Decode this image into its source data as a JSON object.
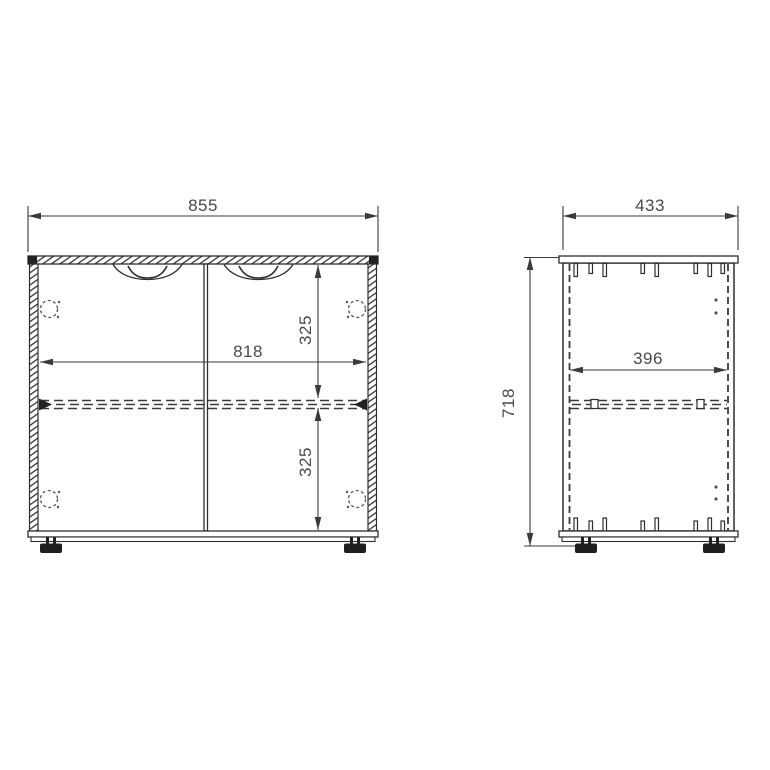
{
  "drawing": {
    "type": "furniture-dimension-drawing",
    "background_color": "#ffffff",
    "line_color": "#2e2e2e",
    "dimension_line_color": "#3a3a3a",
    "text_color": "#4a4a4a",
    "foot_color": "#1f1f1f"
  },
  "front_view": {
    "width_label": "855",
    "inner_width_label": "818",
    "upper_compartment_label": "325",
    "lower_compartment_label": "325"
  },
  "side_view": {
    "depth_label": "433",
    "height_label": "718",
    "inner_depth_label": "396"
  }
}
